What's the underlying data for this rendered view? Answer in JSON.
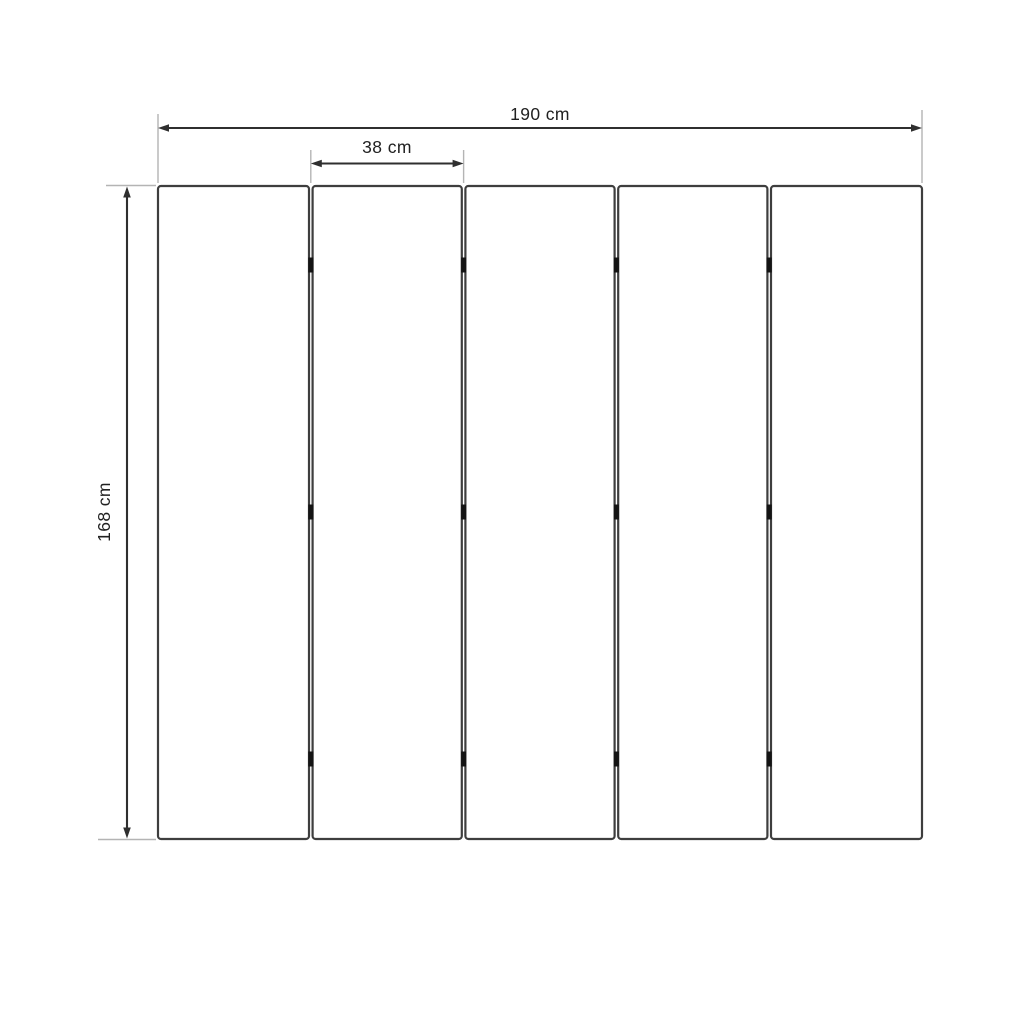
{
  "diagram_type": "folding-screen-dimension-drawing",
  "dimensions": {
    "total_width": {
      "label": "190 cm",
      "value": 190,
      "unit": "cm"
    },
    "panel_width": {
      "label": "38 cm",
      "value": 38,
      "unit": "cm"
    },
    "panel_height": {
      "label": "168 cm",
      "value": 168,
      "unit": "cm"
    }
  },
  "structure": {
    "panel_count": 5,
    "hinge_columns": 4,
    "hinge_rows": 3
  },
  "colors": {
    "background": "#ffffff",
    "panel_stroke": "#3e3e3e",
    "dimension_line": "#2f2f2f",
    "extension_line": "#b4b4b4",
    "hinge": "#141414",
    "label_text": "#212121"
  }
}
